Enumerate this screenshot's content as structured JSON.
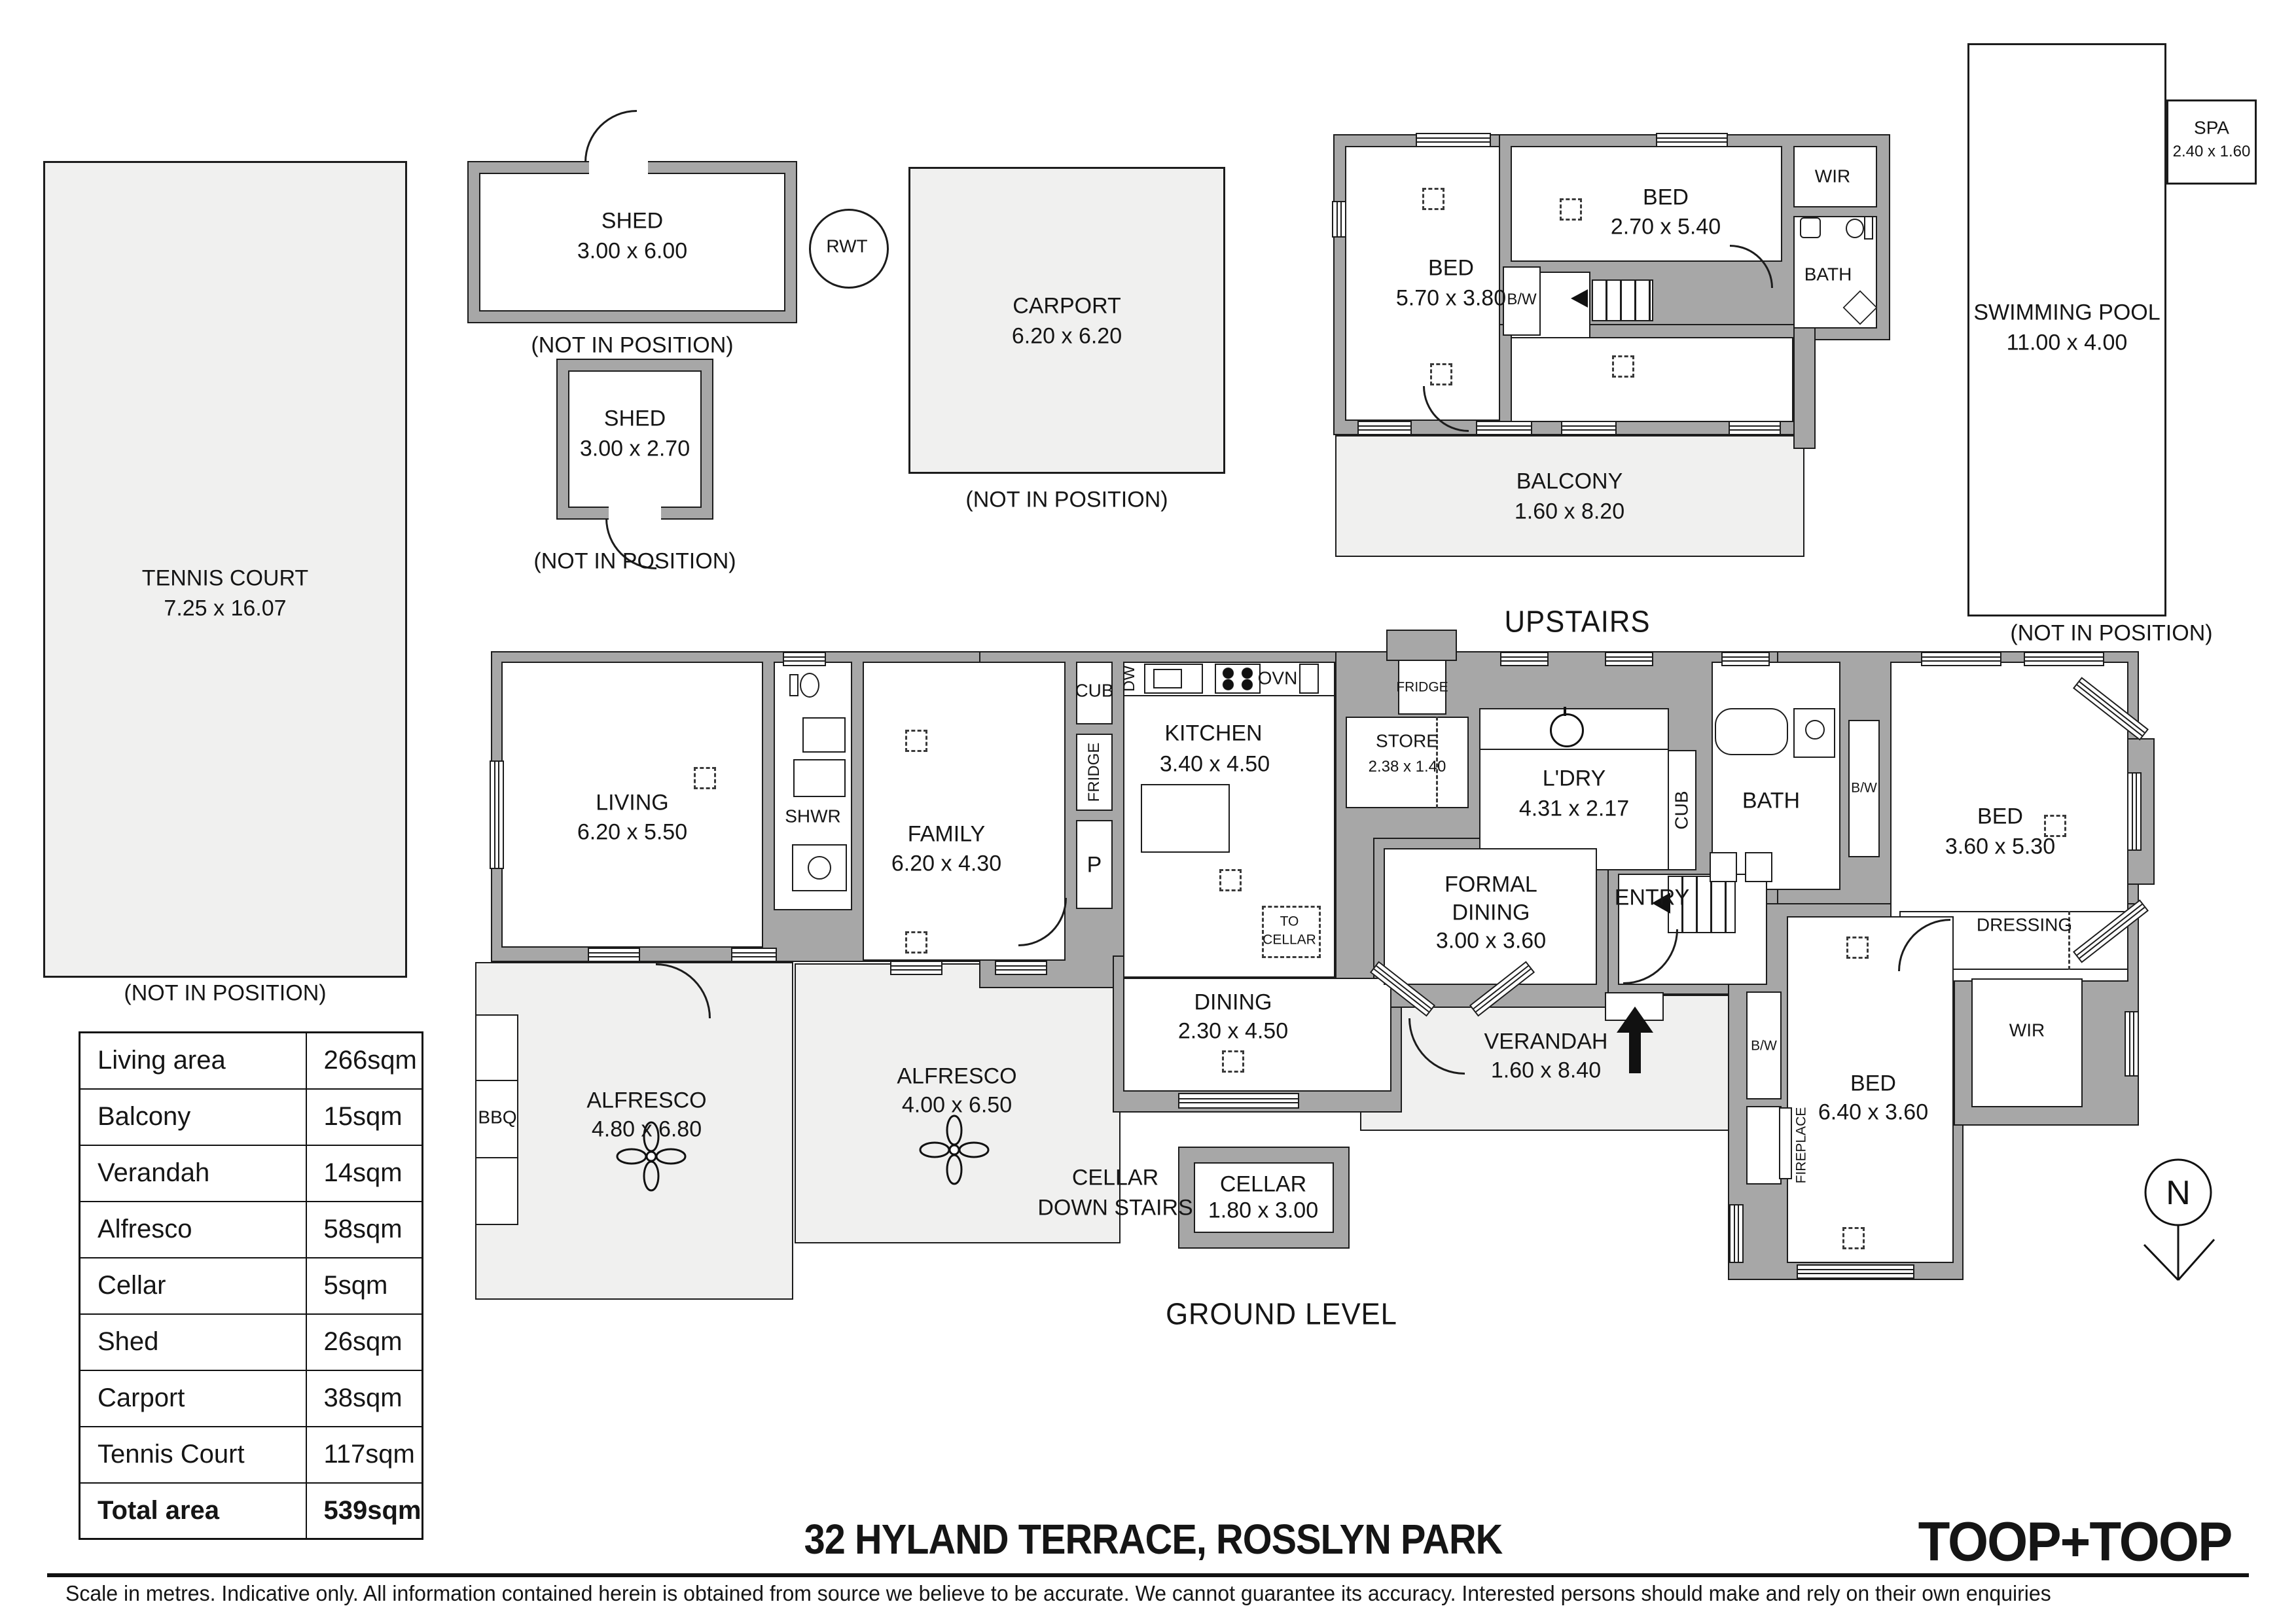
{
  "page": {
    "title": "32 HYLAND TERRACE, ROSSLYN PARK",
    "brand": "TOOP+TOOP",
    "disclaimer": "Scale in metres. Indicative only. All information contained herein is obtained from source we believe to be accurate. We cannot guarantee its accuracy. Interested persons should make and rely on their own enquiries",
    "upstairs_label": "UPSTAIRS",
    "ground_label": "GROUND LEVEL",
    "north_label": "N",
    "not_in_position": "(NOT IN POSITION)"
  },
  "outbuildings": {
    "tennis_court": {
      "name": "TENNIS COURT",
      "dims": "7.25 x 16.07"
    },
    "shed_large": {
      "name": "SHED",
      "dims": "3.00 x 6.00"
    },
    "shed_small": {
      "name": "SHED",
      "dims": "3.00 x 2.70"
    },
    "carport": {
      "name": "CARPORT",
      "dims": "6.20 x 6.20"
    },
    "rwt": {
      "name": "RWT"
    },
    "pool": {
      "name": "SWIMMING POOL",
      "dims": "11.00 x 4.00"
    },
    "spa": {
      "name": "SPA",
      "dims": "2.40 x 1.60"
    }
  },
  "upstairs": {
    "bed_left": {
      "name": "BED",
      "dims": "5.70 x 3.80"
    },
    "bed_right": {
      "name": "BED",
      "dims": "2.70 x 5.40"
    },
    "wir": {
      "name": "WIR"
    },
    "bath": {
      "name": "BATH"
    },
    "bw": {
      "name": "B/W"
    },
    "balcony": {
      "name": "BALCONY",
      "dims": "1.60 x 8.20"
    }
  },
  "ground": {
    "living": {
      "name": "LIVING",
      "dims": "6.20 x 5.50"
    },
    "shwr": {
      "name": "SHWR"
    },
    "family": {
      "name": "FAMILY",
      "dims": "6.20 x 4.30"
    },
    "kitchen": {
      "name": "KITCHEN",
      "dims": "3.40 x 4.50"
    },
    "cub_kitchen": {
      "name": "CUB"
    },
    "fridge_kitchen": {
      "name": "FRIDGE"
    },
    "pantry": {
      "name": "P"
    },
    "dw": {
      "name": "DW"
    },
    "ovn": {
      "name": "OVN"
    },
    "store": {
      "name": "STORE",
      "dims": "2.38 x 1.40"
    },
    "fridge_store": {
      "name": "FRIDGE"
    },
    "laundry": {
      "name": "L'DRY",
      "dims": "4.31 x 2.17"
    },
    "cub_hall": {
      "name": "CUB"
    },
    "bath": {
      "name": "BATH"
    },
    "bw_bath": {
      "name": "B/W"
    },
    "bed_front": {
      "name": "BED",
      "dims": "3.60 x 5.30"
    },
    "entry": {
      "name": "ENTRY"
    },
    "formal_dining": {
      "line1": "FORMAL",
      "line2": "DINING",
      "dims": "3.00 x 3.60"
    },
    "dining": {
      "name": "DINING",
      "dims": "2.30 x 4.50"
    },
    "to_cellar": {
      "line1": "TO",
      "line2": "CELLAR"
    },
    "dressing": {
      "name": "DRESSING"
    },
    "wir": {
      "name": "WIR"
    },
    "bed_rear": {
      "name": "BED",
      "dims": "6.40 x 3.60"
    },
    "bw_bed": {
      "name": "B/W"
    },
    "fireplace": {
      "name": "FIREPLACE"
    },
    "verandah": {
      "name": "VERANDAH",
      "dims": "1.60 x 8.40"
    },
    "alfresco_large": {
      "name": "ALFRESCO",
      "dims": "4.80 x 6.80"
    },
    "alfresco_small": {
      "name": "ALFRESCO",
      "dims": "4.00 x 6.50"
    },
    "bbq": {
      "name": "BBQ"
    },
    "cellar_access": {
      "line1": "CELLAR",
      "line2": "DOWN STAIRS"
    },
    "cellar": {
      "name": "CELLAR",
      "dims": "1.80 x 3.00"
    }
  },
  "area_table": {
    "rows": [
      {
        "label": "Living area",
        "value": "266sqm"
      },
      {
        "label": "Balcony",
        "value": "15sqm"
      },
      {
        "label": "Verandah",
        "value": "14sqm"
      },
      {
        "label": "Alfresco",
        "value": "58sqm"
      },
      {
        "label": "Cellar",
        "value": "5sqm"
      },
      {
        "label": "Shed",
        "value": "26sqm"
      },
      {
        "label": "Carport",
        "value": "38sqm"
      },
      {
        "label": "Tennis Court",
        "value": "117sqm"
      },
      {
        "label": "Total area",
        "value": "539sqm"
      }
    ]
  }
}
